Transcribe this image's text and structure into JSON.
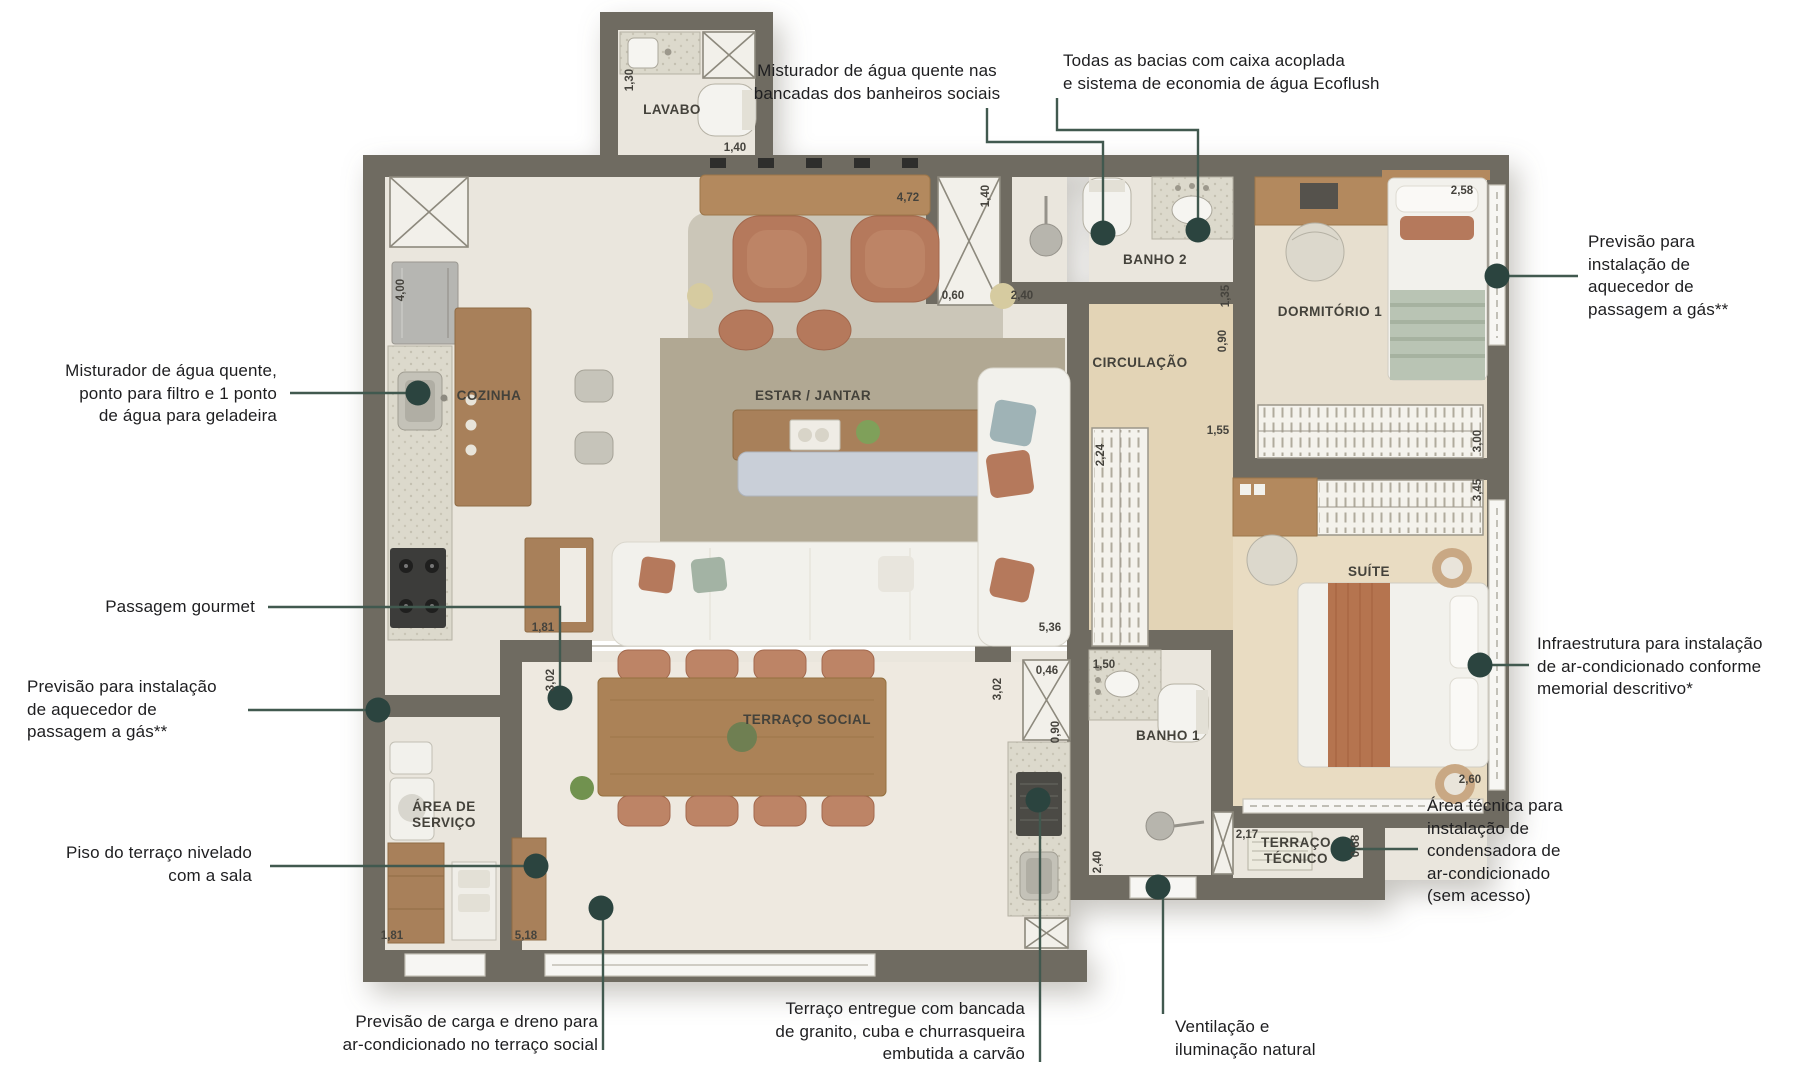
{
  "page": {
    "background": "#ffffff",
    "type": "apartment floor plan with specification callouts",
    "language": "pt-BR"
  },
  "palette": {
    "wall": "#6f6b61",
    "leader_line": "#41594f",
    "callout_dot": "#2b443f",
    "tile_floor": "#eae6dd",
    "terrace_floor": "#eee9e0",
    "wood_floor": "#e3d4b6",
    "dorm_floor": "#e7dfcf",
    "suite_floor": "#e9dcc2",
    "rug_dark": "#b1a893",
    "rug_light": "#cbc6b8",
    "counter": "#dcd9cc",
    "furniture_wood": "#ab8257",
    "upholstery_clay": "#b5795c",
    "linen_white": "#f2f1ec",
    "blanket_sage": "#b9c4b4",
    "runner_rust": "#b5744f",
    "annotation_text": "#1e1e20"
  },
  "rooms": [
    {
      "id": "lavabo",
      "text": "LAVABO",
      "x": 672,
      "y": 110
    },
    {
      "id": "cozinha",
      "text": "COZINHA",
      "x": 489,
      "y": 396
    },
    {
      "id": "estar-jantar",
      "text": "ESTAR / JANTAR",
      "x": 813,
      "y": 396
    },
    {
      "id": "circulacao",
      "text": "CIRCULAÇÃO",
      "x": 1140,
      "y": 363
    },
    {
      "id": "banho-2",
      "text": "BANHO 2",
      "x": 1155,
      "y": 260
    },
    {
      "id": "dormitorio-1",
      "text": "DORMITÓRIO 1",
      "x": 1330,
      "y": 312
    },
    {
      "id": "suite",
      "text": "SUÍTE",
      "x": 1369,
      "y": 572
    },
    {
      "id": "banho-1",
      "text": "BANHO 1",
      "x": 1168,
      "y": 736
    },
    {
      "id": "terraco-social",
      "text": "TERRAÇO SOCIAL",
      "x": 807,
      "y": 720
    },
    {
      "id": "area-de-servico",
      "text": "ÁREA DE\nSERVIÇO",
      "x": 444,
      "y": 815
    },
    {
      "id": "terraco-tecnico",
      "text": "TERRAÇO\nTÉCNICO",
      "x": 1296,
      "y": 851
    }
  ],
  "dimensions": [
    {
      "text": "1,30",
      "x": 630,
      "y": 80,
      "rot": true
    },
    {
      "text": "1,40",
      "x": 735,
      "y": 148,
      "rot": false
    },
    {
      "text": "4,00",
      "x": 401,
      "y": 290,
      "rot": true
    },
    {
      "text": "4,72",
      "x": 908,
      "y": 198,
      "rot": false
    },
    {
      "text": "1,40",
      "x": 986,
      "y": 196,
      "rot": true
    },
    {
      "text": "0,60",
      "x": 953,
      "y": 296,
      "rot": false
    },
    {
      "text": "2,40",
      "x": 1022,
      "y": 296,
      "rot": false
    },
    {
      "text": "2,58",
      "x": 1462,
      "y": 191,
      "rot": false
    },
    {
      "text": "1,35",
      "x": 1226,
      "y": 296,
      "rot": true
    },
    {
      "text": "0,90",
      "x": 1223,
      "y": 341,
      "rot": true
    },
    {
      "text": "1,55",
      "x": 1218,
      "y": 431,
      "rot": false
    },
    {
      "text": "2,24",
      "x": 1101,
      "y": 455,
      "rot": true
    },
    {
      "text": "5,36",
      "x": 1050,
      "y": 628,
      "rot": false
    },
    {
      "text": "3,00",
      "x": 1478,
      "y": 441,
      "rot": true
    },
    {
      "text": "3,45",
      "x": 1478,
      "y": 490,
      "rot": true
    },
    {
      "text": "2,60",
      "x": 1470,
      "y": 780,
      "rot": false
    },
    {
      "text": "1,81",
      "x": 543,
      "y": 628,
      "rot": false
    },
    {
      "text": "3,02",
      "x": 551,
      "y": 680,
      "rot": true
    },
    {
      "text": "3,02",
      "x": 998,
      "y": 689,
      "rot": true
    },
    {
      "text": "0,46",
      "x": 1047,
      "y": 671,
      "rot": false
    },
    {
      "text": "0,90",
      "x": 1056,
      "y": 732,
      "rot": true
    },
    {
      "text": "1,50",
      "x": 1104,
      "y": 665,
      "rot": false
    },
    {
      "text": "2,40",
      "x": 1098,
      "y": 862,
      "rot": true
    },
    {
      "text": "2,17",
      "x": 1247,
      "y": 835,
      "rot": false
    },
    {
      "text": "0,68",
      "x": 1356,
      "y": 846,
      "rot": true
    },
    {
      "text": "1,81",
      "x": 392,
      "y": 936,
      "rot": false
    },
    {
      "text": "5,18",
      "x": 526,
      "y": 936,
      "rot": false
    }
  ],
  "annotations": [
    {
      "id": "misturador-banheiros",
      "text": "Misturador de água quente nas\nbancadas dos banheiros sociais",
      "x": 877,
      "y": 60,
      "align": "center",
      "leader": "987,108 987,142 1103,142 1103,233",
      "dot": [
        1103,
        233
      ]
    },
    {
      "id": "bacias-ecoflush",
      "text": "Todas as bacias com caixa acoplada\ne sistema de economia de água Ecoflush",
      "x": 1063,
      "y": 50,
      "align": "left",
      "leader": "1057,98 1057,130 1198,130 1198,230",
      "dot": [
        1198,
        230
      ]
    },
    {
      "id": "aquecedor-gas-direita",
      "text": "Previsão para\ninstalação de\naquecedor de\npassagem a gás**",
      "x": 1588,
      "y": 231,
      "align": "left",
      "leader": "1578,276 1508,276",
      "dot": [
        1497,
        276
      ]
    },
    {
      "id": "misturador-cozinha",
      "text": "Misturador de água quente,\nponto para filtro e 1 ponto\nde água para geladeira",
      "x": 277,
      "y": 360,
      "align": "right",
      "leader": "290,393 417,393",
      "dot": [
        418,
        393
      ]
    },
    {
      "id": "passagem-gourmet",
      "text": "Passagem gourmet",
      "x": 255,
      "y": 596,
      "align": "right",
      "leader": "268,607 560,607 560,694",
      "dot": [
        560,
        698
      ]
    },
    {
      "id": "aquecedor-gas-esquerda",
      "text": "Previsão para instalação\nde aquecedor de\npassagem a gás**",
      "x": 27,
      "y": 676,
      "align": "left",
      "leader": "248,710 376,710",
      "dot": [
        378,
        710
      ]
    },
    {
      "id": "piso-terraco",
      "text": "Piso do terraço nivelado\ncom a sala",
      "x": 252,
      "y": 842,
      "align": "right",
      "leader": "270,866 533,866",
      "dot": [
        536,
        866
      ]
    },
    {
      "id": "carga-dreno-ar",
      "text": "Previsão de carga e dreno para\nar-condicionado no terraço social",
      "x": 598,
      "y": 1011,
      "align": "right",
      "leader": "603,1050 603,912",
      "dot": [
        601,
        908
      ]
    },
    {
      "id": "terraco-bancada",
      "text": "Terraço entregue com bancada\nde granito, cuba e churrasqueira\nembutida a carvão",
      "x": 1025,
      "y": 998,
      "align": "right",
      "leader": "1040,1062 1040,804",
      "dot": [
        1038,
        800
      ]
    },
    {
      "id": "ventilacao-natural",
      "text": "Ventilação e\niluminação natural",
      "x": 1175,
      "y": 1016,
      "align": "left",
      "leader": "1163,1014 1163,891",
      "dot": [
        1158,
        887
      ]
    },
    {
      "id": "infraestrutura-ar",
      "text": "Infraestrutura para instalação\nde ar-condicionado conforme\nmemorial descritivo*",
      "x": 1537,
      "y": 633,
      "align": "left",
      "leader": "1529,665 1492,665",
      "dot": [
        1480,
        665
      ]
    },
    {
      "id": "area-tecnica-condensadora",
      "text": "Área técnica para\ninstalação de\ncondensadora de\nar-condicionado\n(sem acesso)",
      "x": 1427,
      "y": 795,
      "align": "left",
      "leader": "1418,849 1355,849",
      "dot": [
        1343,
        849
      ]
    }
  ]
}
